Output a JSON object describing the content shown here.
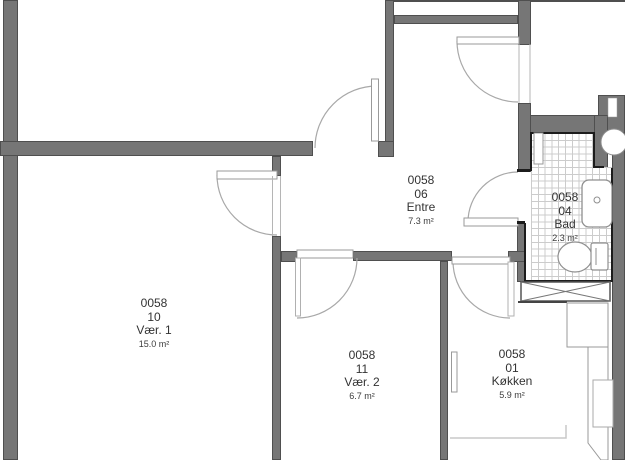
{
  "plan_title": "Apartment floor plan 0058",
  "rooms": [
    {
      "code": "0058",
      "number": "10",
      "name": "Vær. 1",
      "area": "15.0 m²"
    },
    {
      "code": "0058",
      "number": "11",
      "name": "Vær. 2",
      "area": "6.7 m²"
    },
    {
      "code": "0058",
      "number": "06",
      "name": "Entre",
      "area": "7.3 m²"
    },
    {
      "code": "0058",
      "number": "01",
      "name": "Køkken",
      "area": "5.9 m²"
    },
    {
      "code": "0058",
      "number": "04",
      "name": "Bad",
      "area": "2.3 m²"
    }
  ],
  "colors": {
    "wall": "#767676",
    "wall_edge": "#4f4f4f",
    "wet_room_accent": "#1c1c1c",
    "tile_grid": "#cccccc",
    "door_swing": "#a8a8a8",
    "text": "#333333",
    "background": "#ffffff"
  }
}
